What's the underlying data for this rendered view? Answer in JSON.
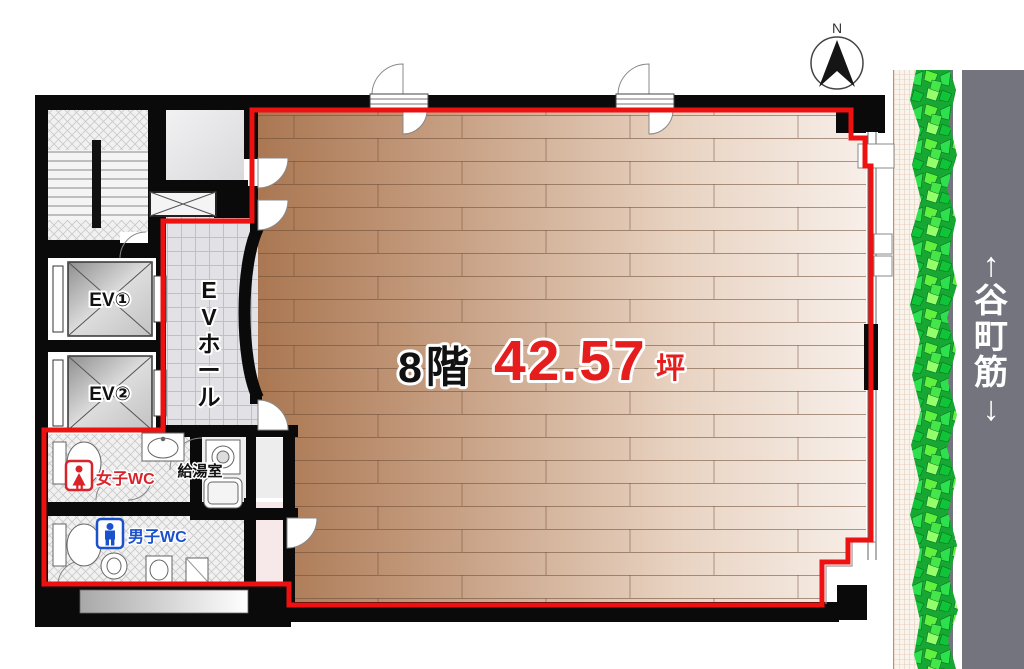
{
  "fp": {
    "floor_label": "8階",
    "area_value": "42.57",
    "area_unit": "坪",
    "compass_north": "N",
    "street": {
      "name": "谷町筋",
      "chars": [
        "↑",
        "谷",
        "町",
        "筋",
        "↓"
      ]
    },
    "rooms": {
      "elevator1": "EV①",
      "elevator2": "EV②",
      "ev_hall": "EVホール",
      "ev_hall_chars": [
        "E",
        "V",
        "ホ",
        "ー",
        "ル"
      ],
      "womens_wc": "女子WC",
      "mens_wc": "男子WC",
      "kitchenette": "給湯室"
    },
    "colors": {
      "lease_boundary": "#ee1111",
      "area_text": "#e51d1d",
      "floor_text": "#111111",
      "wall": "#0a0a0a",
      "road": "#74747e",
      "hedge_green": "#2db93c",
      "wood_dark": "#aa7752",
      "wood_light": "#f7efe9",
      "wc_red": "#d8232a",
      "wc_blue": "#1a51cc"
    }
  }
}
